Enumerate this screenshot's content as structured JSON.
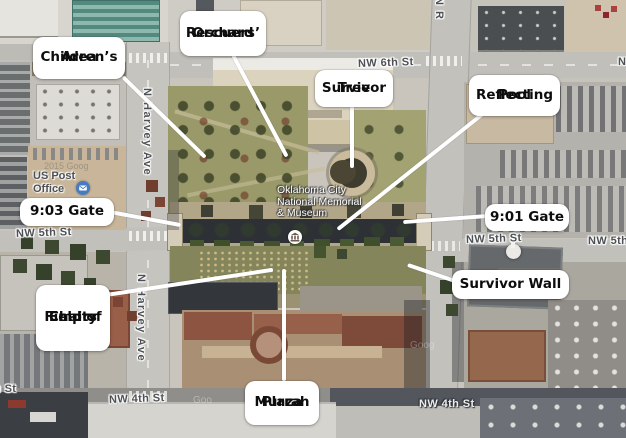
{
  "annotations": {
    "children_area": {
      "line1": "Children’s",
      "line2": "Area"
    },
    "rescuers_orchard": {
      "line1": "Rescuers’",
      "line2": "Orchard"
    },
    "survivor_tree": {
      "line1": "Survivor",
      "line2": "Tree"
    },
    "reflecting_pool": {
      "line1": "Reflecting",
      "line2": "Pool"
    },
    "gate_903": {
      "line1": "9:03 Gate"
    },
    "gate_901": {
      "line1": "9:01 Gate"
    },
    "survivor_wall": {
      "line1": "Survivor Wall"
    },
    "field_of_empty_chairs": {
      "line1": "Field of",
      "line2": "Empty",
      "line3": "Chairs"
    },
    "murrah_plaza": {
      "line1": "Murrah",
      "line2": "Plaza"
    }
  },
  "place_labels": {
    "memorial": {
      "line1": "Oklahoma City",
      "line2": "National Memorial",
      "line3": "& Museum"
    },
    "post_office": {
      "line1": "US Post",
      "line2": "Office"
    }
  },
  "street_labels": {
    "nw_6th": "NW 6th St",
    "nw_5th_left": "NW 5th St",
    "nw_5th_mid": "NW 5th St",
    "nw_5th_right_edge": "NW 5th",
    "nw_4th_left": "NW 4th St",
    "nw_4th_right": "NW 4th St",
    "nw_4th_left_partial": "h St",
    "n_harvey_upper": "N Harvey Ave",
    "n_harvey_lower": "N Harvey Ave",
    "n_robinson_partial": "N R",
    "right_edge_partial": "N"
  },
  "watermarks": {
    "w1": "2015 Goog",
    "w2": "Goog",
    "w3": "Goo"
  },
  "icons": {
    "museum": "museum-icon",
    "mail": "mail-icon"
  },
  "colors": {
    "callout_bg": "#ffffff",
    "callout_text": "#0d0d0d",
    "leader_line": "#ffffff",
    "street_label_gray": "#4d5155",
    "street_label_light": "#eceded",
    "post_icon_blue": "#477cc2",
    "pool_dark": "#2d3135",
    "lawn_olive": "#99996a"
  }
}
